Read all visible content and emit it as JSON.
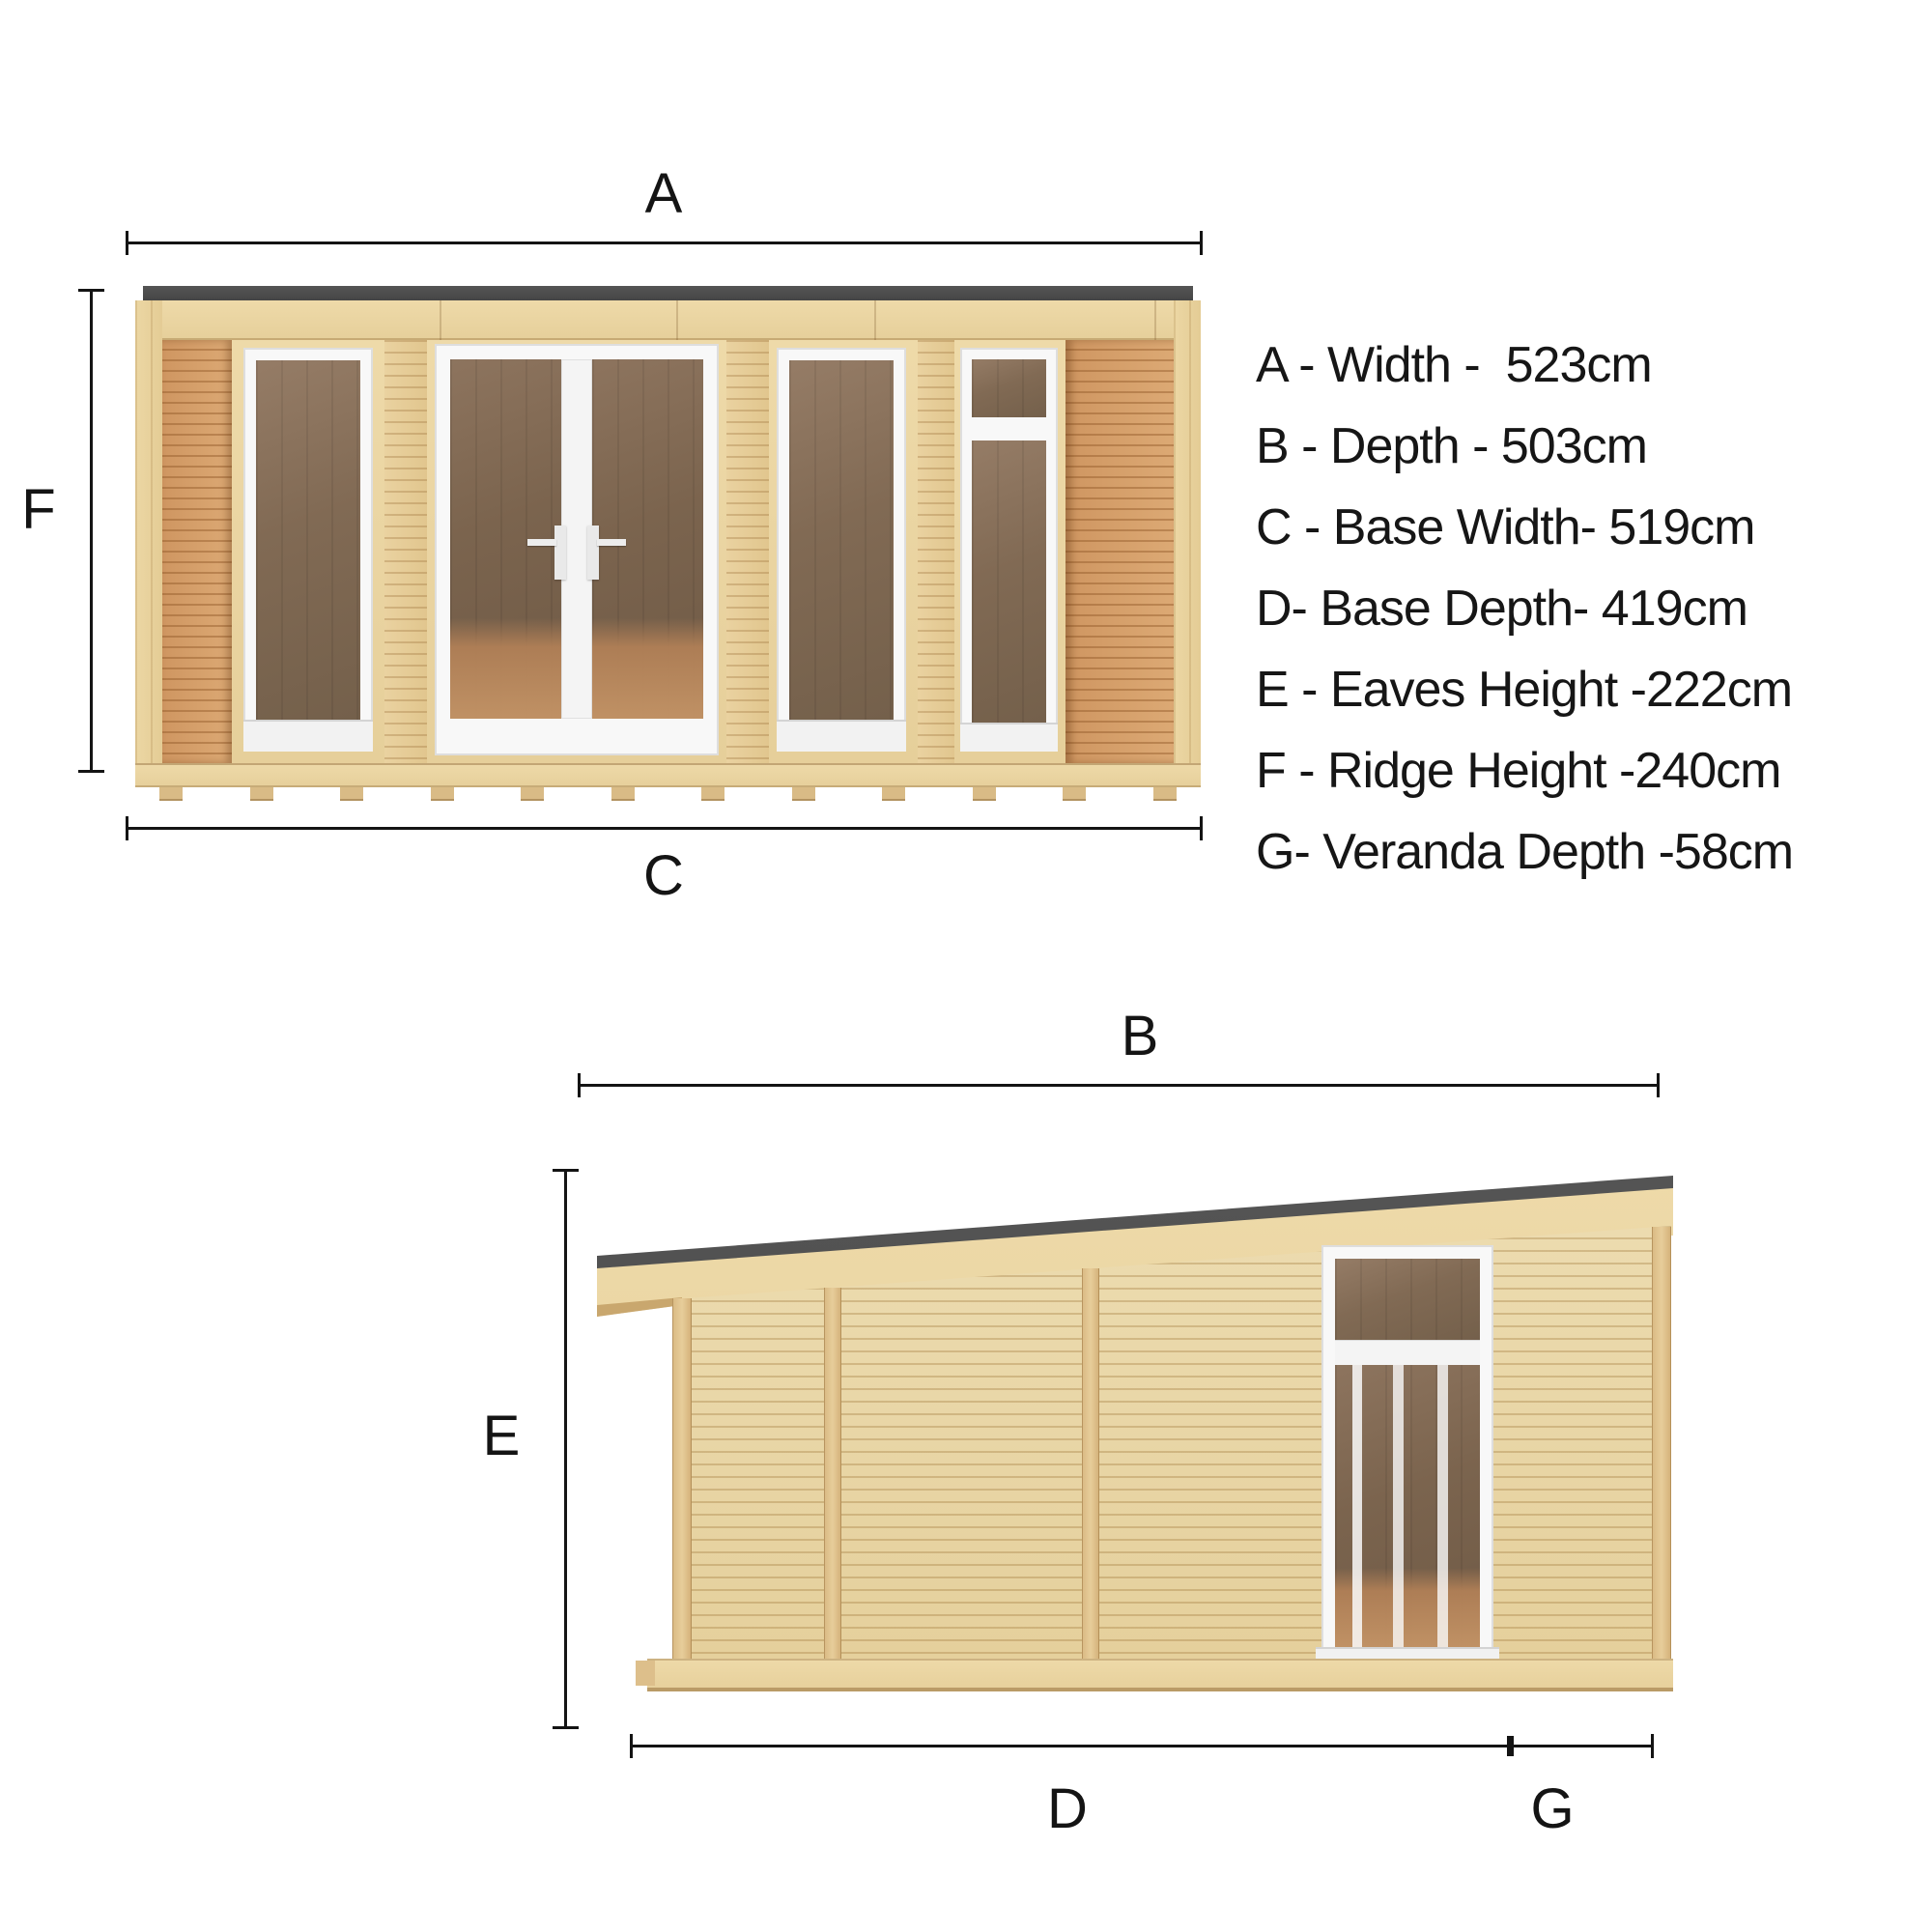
{
  "title": "Garden room dimension diagram",
  "views": {
    "front": {
      "name": "Front elevation",
      "top_dim": "A",
      "left_dim": "F",
      "bottom_dim": "C"
    },
    "side": {
      "name": "Side elevation",
      "top_dim": "B",
      "left_dim": "E",
      "bottom_main_dim": "D",
      "bottom_veranda_dim": "G"
    }
  },
  "legend": {
    "items": [
      {
        "letter": "A",
        "label": "Width",
        "value": "523cm",
        "text": "A - Width -  523cm"
      },
      {
        "letter": "B",
        "label": "Depth",
        "value": "503cm",
        "text": "B - Depth - 503cm"
      },
      {
        "letter": "C",
        "label": "Base Width",
        "value": "519cm",
        "text": "C - Base Width- 519cm"
      },
      {
        "letter": "D",
        "label": "Base Depth",
        "value": "419cm",
        "text": "D- Base Depth- 419cm"
      },
      {
        "letter": "E",
        "label": "Eaves Height",
        "value": "222cm",
        "text": "E - Eaves Height -222cm"
      },
      {
        "letter": "F",
        "label": "Ridge Height",
        "value": "240cm",
        "text": "F - Ridge Height -240cm"
      },
      {
        "letter": "G",
        "label": "Veranda Depth",
        "value": "58cm",
        "text": "G- Veranda Depth -58cm"
      }
    ]
  },
  "colors": {
    "background": "#ffffff",
    "dimension_line": "#141414",
    "roof_edge": "#4b4b4b",
    "pine_light": "#eddaab",
    "pine_board_line": "#b79963",
    "cheek_orange": "#d49b68",
    "batten_tan": "#dec08d",
    "frame_white": "#f8f8f8",
    "glass_brown": "#80684f",
    "floor_brown": "#a97f5a"
  }
}
